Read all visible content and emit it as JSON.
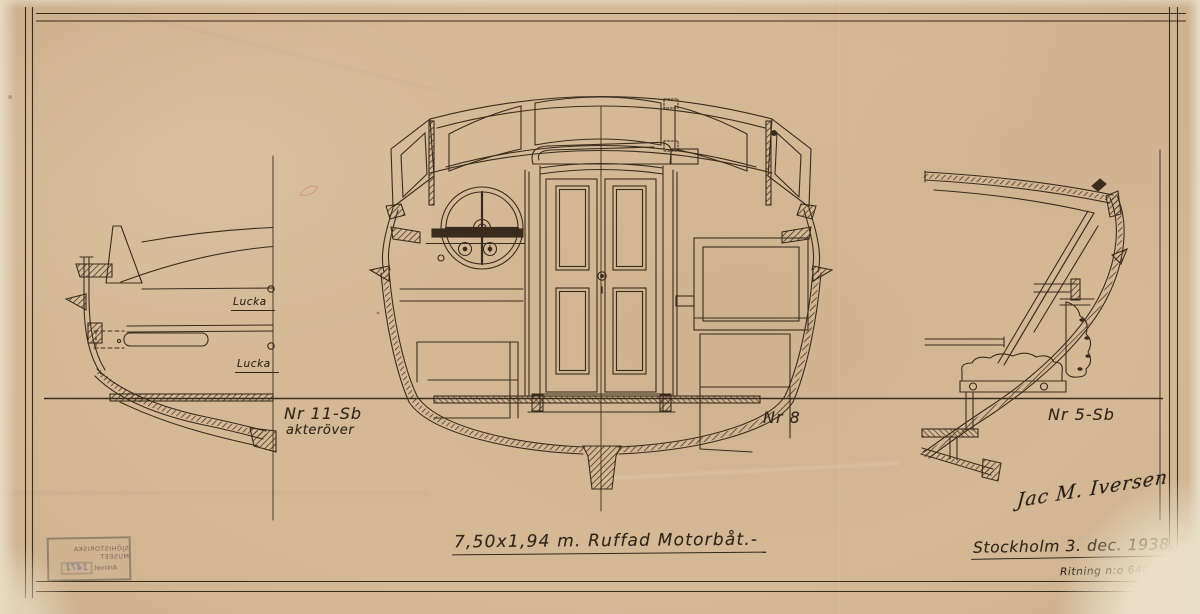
{
  "sheet": {
    "title": "7,50x1,94 m. Ruffad Motorbåt.-",
    "signature": "Jac M. Iversen",
    "place_date": "Stockholm 3. dec. 1938.",
    "drawing_number": "Ritning n:o 640 c"
  },
  "sections": {
    "aft": {
      "label": "Nr 11-Sb",
      "sublabel": "akteröver",
      "hatch_1": "Lucka",
      "hatch_2": "Lucka"
    },
    "mid": {
      "label": "Nr 8"
    },
    "fore": {
      "label": "Nr 5-Sb"
    }
  },
  "stamp": {
    "museum": "SJÖHISTORISKA MUSEET",
    "archive": "Arkivet",
    "number": "1471"
  },
  "colors": {
    "paper": "#d5b997",
    "ink": "#3a2c1c",
    "stamp_blue": "#4a5f8a"
  }
}
